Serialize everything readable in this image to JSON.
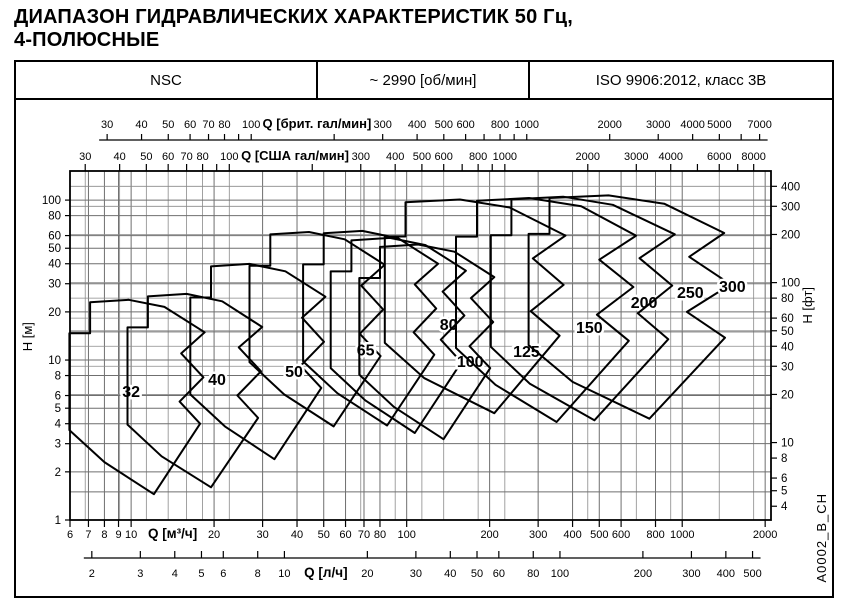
{
  "title": {
    "line1": "ДИАПАЗОН ГИДРАВЛИЧЕСКИХ ХАРАКТЕРИСТИК 50 Гц,",
    "line2": "4-ПОЛЮСНЫЕ"
  },
  "header": {
    "series": "NSC",
    "speed": "~ 2990 [об/мин]",
    "standard": "ISO 9906:2012, класс 3В"
  },
  "side_code": "A0002_B_CH",
  "chart_data": {
    "type": "area",
    "description": "Hydraulic coverage envelopes (Q-H ranges) for NSC pump sizes, log-log scales",
    "grid": true,
    "x_axis_main": {
      "label": "Q [м³/ч]",
      "scale": "log",
      "range": [
        6,
        2100
      ],
      "ticks": [
        6,
        7,
        8,
        9,
        10,
        20,
        30,
        40,
        50,
        60,
        70,
        80,
        100,
        200,
        300,
        400,
        500,
        600,
        800,
        1000,
        2000
      ],
      "minor_ticks": []
    },
    "x_axis_lps": {
      "label": "Q [л/ч]",
      "factor_to_m3h": 3.6,
      "ticks": [
        2,
        3,
        4,
        5,
        6,
        8,
        10,
        20,
        30,
        40,
        50,
        60,
        80,
        100,
        200,
        300,
        400,
        500
      ],
      "minor_ticks": []
    },
    "x_axis_imp": {
      "label": "Q [брит. гал/мин]",
      "factor_to_m3h": 0.27277,
      "ticks": [
        30,
        40,
        50,
        60,
        70,
        80,
        100,
        300,
        400,
        500,
        600,
        800,
        1000,
        2000,
        3000,
        4000,
        5000,
        7000
      ],
      "minor_ticks": [
        90,
        200,
        700,
        900,
        6000
      ]
    },
    "x_axis_us": {
      "label": "Q [США гал/мин]",
      "factor_to_m3h": 0.22712,
      "ticks": [
        30,
        40,
        50,
        60,
        70,
        80,
        100,
        300,
        400,
        500,
        600,
        800,
        1000,
        2000,
        3000,
        4000,
        6000,
        8000
      ],
      "minor_ticks": [
        90,
        200,
        700,
        900,
        5000,
        7000
      ]
    },
    "y_axis_m": {
      "label": "H [м]",
      "scale": "log",
      "range": [
        1,
        152
      ],
      "ticks": [
        1,
        2,
        3,
        4,
        5,
        6,
        8,
        10,
        20,
        30,
        40,
        50,
        60,
        80,
        100
      ],
      "gridlines": [
        1,
        1.5,
        2,
        3,
        4,
        5,
        6,
        8,
        10,
        15,
        20,
        30,
        40,
        50,
        60,
        80,
        100
      ]
    },
    "y_axis_ft": {
      "label": "H [фт]",
      "factor_to_m": 0.3048,
      "ticks": [
        4,
        5,
        6,
        8,
        10,
        20,
        30,
        40,
        50,
        60,
        80,
        100,
        200,
        300,
        400
      ],
      "gridlines": [
        20,
        30,
        40,
        50,
        60,
        80,
        100,
        200,
        300,
        400
      ]
    },
    "envelopes": [
      {
        "label": "32",
        "label_at": [
          10,
          6.3
        ],
        "points": [
          [
            5.97,
            3.65
          ],
          [
            5.97,
            14.7
          ],
          [
            7.1,
            14.7
          ],
          [
            7.1,
            23
          ],
          [
            9.8,
            23.8
          ],
          [
            13.2,
            21.5
          ],
          [
            18.5,
            14.9
          ],
          [
            15.2,
            11
          ],
          [
            18.3,
            7.8
          ],
          [
            15,
            5.5
          ],
          [
            17.8,
            4
          ],
          [
            12.1,
            1.45
          ],
          [
            8,
            2.3
          ]
        ]
      },
      {
        "label": "40",
        "label_at": [
          20.5,
          7.5
        ],
        "points": [
          [
            9.7,
            3.95
          ],
          [
            9.7,
            16
          ],
          [
            11.5,
            16
          ],
          [
            11.5,
            25
          ],
          [
            15.9,
            25.9
          ],
          [
            21.4,
            23.3
          ],
          [
            29.9,
            16.1
          ],
          [
            24.6,
            12
          ],
          [
            29.6,
            8.5
          ],
          [
            24.3,
            6
          ],
          [
            28.9,
            4.35
          ],
          [
            19.5,
            1.6
          ],
          [
            12.9,
            2.5
          ]
        ]
      },
      {
        "label": "50",
        "label_at": [
          39,
          8.4
        ],
        "points": [
          [
            16.4,
            6.1
          ],
          [
            16.4,
            24.6
          ],
          [
            19.5,
            24.6
          ],
          [
            19.5,
            38.5
          ],
          [
            26.9,
            39.9
          ],
          [
            36.3,
            35.9
          ],
          [
            50.7,
            24.9
          ],
          [
            41.7,
            18.4
          ],
          [
            50.1,
            13
          ],
          [
            41.2,
            9.2
          ],
          [
            49,
            6.7
          ],
          [
            33.1,
            2.4
          ],
          [
            21.9,
            3.85
          ]
        ]
      },
      {
        "label": "65",
        "label_at": [
          71,
          11.5
        ],
        "points": [
          [
            26.9,
            9.7
          ],
          [
            26.9,
            38.9
          ],
          [
            32,
            38.9
          ],
          [
            32,
            61
          ],
          [
            44.2,
            63.2
          ],
          [
            59.6,
            56.9
          ],
          [
            83.2,
            39.4
          ],
          [
            68.4,
            29.2
          ],
          [
            82.2,
            20.7
          ],
          [
            67.6,
            14.6
          ],
          [
            80.4,
            10.6
          ],
          [
            54.3,
            3.85
          ],
          [
            35.9,
            6.1
          ]
        ]
      },
      {
        "label": "80",
        "label_at": [
          142,
          16.6
        ],
        "points": [
          [
            42.1,
            9.8
          ],
          [
            42.1,
            39.6
          ],
          [
            50,
            39.6
          ],
          [
            50,
            62
          ],
          [
            69,
            64.2
          ],
          [
            93.1,
            57.8
          ],
          [
            130,
            40
          ],
          [
            107,
            29.7
          ],
          [
            128,
            21
          ],
          [
            106,
            14.9
          ],
          [
            126,
            10.8
          ],
          [
            84.9,
            3.9
          ],
          [
            56.1,
            6.2
          ]
        ]
      },
      {
        "label": "100",
        "label_at": [
          170,
          9.7
        ],
        "points": [
          [
            53,
            8.9
          ],
          [
            53,
            35.8
          ],
          [
            63,
            35.8
          ],
          [
            63,
            56
          ],
          [
            87,
            58
          ],
          [
            117,
            52.3
          ],
          [
            164,
            36.2
          ],
          [
            135,
            26.8
          ],
          [
            162,
            19
          ],
          [
            133,
            13.4
          ],
          [
            158,
            9.7
          ],
          [
            107,
            3.5
          ],
          [
            70.7,
            5.6
          ]
        ]
      },
      {
        "label": "125",
        "label_at": [
          272,
          11.2
        ],
        "points": [
          [
            67.3,
            8.1
          ],
          [
            67.3,
            32.6
          ],
          [
            80,
            32.6
          ],
          [
            80,
            51
          ],
          [
            110,
            52.8
          ],
          [
            149,
            47.6
          ],
          [
            208,
            33
          ],
          [
            171,
            24.4
          ],
          [
            206,
            17.3
          ],
          [
            169,
            12.2
          ],
          [
            201,
            8.9
          ],
          [
            136,
            3.2
          ],
          [
            89.8,
            5.1
          ]
        ]
      },
      {
        "label": "150",
        "label_at": [
          460,
          15.9
        ],
        "points": [
          [
            83.3,
            12.8
          ],
          [
            83.3,
            59.2
          ],
          [
            99,
            59.2
          ],
          [
            99,
            97
          ],
          [
            156,
            100.8
          ],
          [
            236,
            90
          ],
          [
            377,
            60
          ],
          [
            287,
            43.2
          ],
          [
            371,
            29.5
          ],
          [
            282,
            20.2
          ],
          [
            359,
            14.2
          ],
          [
            208,
            4.65
          ],
          [
            116,
            7.7
          ]
        ]
      },
      {
        "label": "200",
        "label_at": [
          727,
          22.7
        ],
        "points": [
          [
            151,
            11.9
          ],
          [
            151,
            59.1
          ],
          [
            180,
            59.1
          ],
          [
            180,
            99
          ],
          [
            278,
            103
          ],
          [
            430,
            91.5
          ],
          [
            680,
            59.9
          ],
          [
            500,
            42.4
          ],
          [
            665,
            28.6
          ],
          [
            490,
            19.2
          ],
          [
            640,
            13.2
          ],
          [
            350,
            4.1
          ],
          [
            210,
            7
          ]
        ]
      },
      {
        "label": "250",
        "label_at": [
          1070,
          26.3
        ],
        "points": [
          [
            202,
            12.1
          ],
          [
            202,
            60.3
          ],
          [
            240,
            60.3
          ],
          [
            240,
            101
          ],
          [
            370,
            105
          ],
          [
            560,
            93.4
          ],
          [
            940,
            61.1
          ],
          [
            700,
            43.3
          ],
          [
            920,
            29.2
          ],
          [
            690,
            19.6
          ],
          [
            890,
            13.5
          ],
          [
            480,
            4.2
          ],
          [
            280,
            7.1
          ]
        ]
      },
      {
        "label": "300",
        "label_at": [
          1520,
          28.7
        ],
        "points": [
          [
            277,
            12.4
          ],
          [
            277,
            61.5
          ],
          [
            330,
            61.5
          ],
          [
            330,
            103
          ],
          [
            540,
            107
          ],
          [
            860,
            95
          ],
          [
            1420,
            62.3
          ],
          [
            1060,
            44.2
          ],
          [
            1500,
            29.7
          ],
          [
            1040,
            20
          ],
          [
            1430,
            13.8
          ],
          [
            760,
            4.3
          ],
          [
            400,
            7.3
          ]
        ]
      }
    ]
  }
}
